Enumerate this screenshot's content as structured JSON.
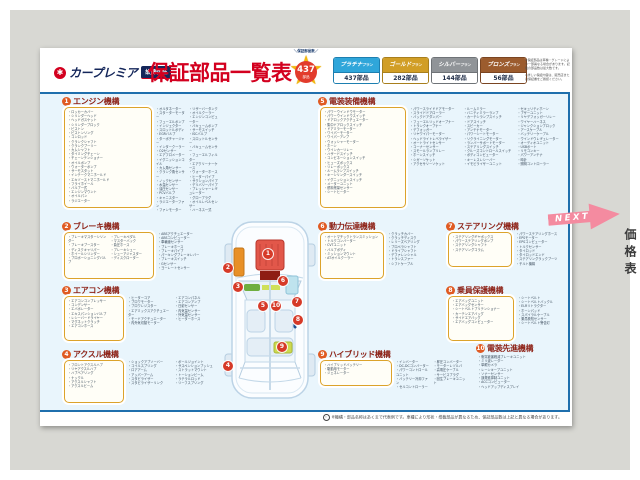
{
  "brand": {
    "name": "カープレミア",
    "badge": "故障保証"
  },
  "title": "保証部品一覧表",
  "count_badge": {
    "label": "＼保証部品数／",
    "count": "437",
    "unit": "部品"
  },
  "plans": [
    {
      "key": "platinum",
      "name": "プラチナ",
      "suffix": "プラン",
      "count": "437部品",
      "color": "#2fa6da",
      "dark": "#1d7fb0"
    },
    {
      "key": "gold",
      "name": "ゴールド",
      "suffix": "プラン",
      "count": "282部品",
      "color": "#d19e26",
      "dark": "#a87f1d"
    },
    {
      "key": "silver",
      "name": "シルバー",
      "suffix": "プラン",
      "count": "144部品",
      "color": "#909498",
      "dark": "#6f7377"
    },
    {
      "key": "bronze",
      "name": "ブロンズ",
      "suffix": "プラン",
      "count": "56部品",
      "color": "#9c5c2e",
      "dark": "#7a4522"
    }
  ],
  "header_notes": [
    "※保証部品は車種・グレードにより一部異なる場合があります。記載の部品数は最大数です。",
    "※詳しい保証内容は、販売店または保証書をご確認ください。"
  ],
  "sections": [
    {
      "key": "engine",
      "num": "1",
      "title": "エンジン機構",
      "box": [
        "ロッカーカバー",
        "シリンダーヘッド",
        "ヘッドガスケット",
        "シリンダーブロック",
        "ピストン",
        "ピストンリング",
        "コンロッド",
        "クランクシャフト",
        "クランクプーリー",
        "カムシャフト",
        "タイミングチェーン",
        "チェーンテンショナー",
        "オイルポンプ",
        "ウォーターポンプ",
        "サーモスタット",
        "インテークマニホールド",
        "エキゾーストマニホールド",
        "フライホイール",
        "バルブ一式",
        "エンジンマウント",
        "オイルパン",
        "ラジエーター"
      ],
      "out": [
        "オルタネーター",
        "スターターモーター",
        "フューエルポンプ",
        "インジェクター",
        "スロットルボディ",
        "EGRバルブ",
        "ターボチャージャー",
        "インタークーラー",
        "O2センサー",
        "エアフロメーター",
        "イグニッションコイル",
        "カム角センサー",
        "クランク角センサー",
        "ノックセンサー",
        "水温センサー",
        "油圧センサー",
        "PCVバルブ",
        "キャニスター",
        "ラジエーターファン",
        "ファンモーター",
        "リザーバータンク",
        "オイルクーラー",
        "エンジンコンピューター",
        "バキュームポンプ",
        "サーモスイッチ",
        "ISCバルブ",
        "スロットルセンサー",
        "バキュームセンサー",
        "フューエルフィルター",
        "エアクリーナーケース",
        "ウォーターホース",
        "ヒーターパイプ",
        "サクションパイプ",
        "デリバリーパイプ",
        "プレッシャーレギュレーター",
        "グロープラグ",
        "オイルレベルセンサー",
        "ハーネス一式"
      ]
    },
    {
      "key": "brake",
      "num": "2",
      "title": "ブレーキ機構",
      "box": [
        "ブレーキマスターシリンダー",
        "ブレーキブースター",
        "ディスクキャリパー",
        "ホイールシリンダー",
        "プロポーショニングバルブ",
        "ブレーキペダル",
        "マスターバック",
        "負圧ホース",
        "ブレーキシュー",
        "シューアジャスター",
        "ディスクローター"
      ],
      "out": [
        "ABSアクチュエーター",
        "ABSコンピューター",
        "車輪速センサー",
        "ブレーキホース",
        "ブレーキパイプ",
        "パーキングブレーキレバー",
        "ブレーキスイッチ",
        "Gセンサー",
        "ヨーレートセンサー"
      ]
    },
    {
      "key": "aircon",
      "num": "3",
      "title": "エアコン機構",
      "box": [
        "エアコンコンプレッサー",
        "コンデンサー",
        "エバポレーター",
        "エキスパンションバルブ",
        "レシーバードライヤー",
        "マグネットクラッチ",
        "エアコンホース"
      ],
      "out": [
        "ヒーターコア",
        "ブロワモーター",
        "ブロワレジスター",
        "エアミックスアクチュエーター",
        "モードアクチュエーター",
        "内外気切替モーター",
        "エアコンパネル",
        "エアコンアンプ",
        "日射センサー",
        "内気温センサー",
        "外気温センサー",
        "ヒーターホース"
      ]
    },
    {
      "key": "axle",
      "num": "4",
      "title": "アクスル機構",
      "box": [
        "フロントアクスルハブ",
        "リヤアクスルハブ",
        "ハブベアリング",
        "ナックル",
        "アクスルシャフト",
        "アクスルビーム"
      ],
      "out": [
        "ショックアブソーバー",
        "コイルスプリング",
        "ロアアーム",
        "アッパーアーム",
        "スタビライザー",
        "スタビライザーリンク",
        "ボールジョイント",
        "サスペンションブッシュ",
        "ストラットマウント",
        "トーションビーム",
        "ラテラルロッド",
        "リーフスプリング"
      ]
    },
    {
      "key": "electrical",
      "num": "5",
      "title": "電装装備機構",
      "box": [
        "パワーウインドウモーター",
        "パワーウインドウスイッチ",
        "ドアロックアクチュエーター",
        "集中ドアロックスイッチ",
        "ドアミラーモーター",
        "ワイパーモーター",
        "ワイパーアンプ",
        "ウォッシャーモーター",
        "ホーン",
        "ウインカーリレー",
        "ハザードスイッチ",
        "コンビネーションスイッチ",
        "ヒューズボックス",
        "リレーボックス",
        "ルームランプスイッチ",
        "キーシリンダースイッチ",
        "イグニッションスイッチ",
        "メーターユニット",
        "燃料残量センサー",
        "シートヒーター"
      ],
      "out": [
        "パワースライドドアモーター",
        "スライドドアローラー",
        "バックドアダンパー",
        "フューエルリッドオープナー",
        "トランクオープナー",
        "デフォッガー",
        "リヤワイパーモーター",
        "ヘッドライトレベライザー",
        "オートライトセンサー",
        "コーナーセンサー",
        "スモールランプリレー",
        "ホーンスイッチ",
        "シガーソケット",
        "アクセサリーソケット",
        "ルームミラー",
        "バニティミラーランプ",
        "カーテシランプスイッチ",
        "ドアスイッチ",
        "スピーカー",
        "アンテナモーター",
        "パワーシートモーター",
        "リクライニングモーター",
        "ランバーサポートモーター",
        "ステアリングスイッチ",
        "クルーズコントロールスイッチ",
        "ボディコンピューター",
        "キーレスレシーバー",
        "イモビライザーユニット",
        "セキュリティホーン",
        "ブザーユニット",
        "リヤデフォッガーリレー",
        "ワイヤーハーネス",
        "ジャンクションブロック",
        "アースケーブル",
        "バッテリーケーブル",
        "ウインドウレギュレーター",
        "オーディオユニット",
        "USBポート",
        "リモコンキー",
        "パワーアンテナ",
        "時計",
        "照明コントローラー"
      ]
    },
    {
      "key": "drivetrain",
      "num": "6",
      "title": "動力伝達機構",
      "box": [
        "オートマチックトランスミッション",
        "トルクコンバーター",
        "CVTユニット",
        "バルブボディ",
        "ミッションマウント",
        "ATオイルクーラー"
      ],
      "out": [
        "クラッチカバー",
        "クラッチディスク",
        "レリーズベアリング",
        "プロペラシャフト",
        "ドライブシャフト",
        "デファレンシャル",
        "トランスファー",
        "シフトケーブル"
      ]
    },
    {
      "key": "steering",
      "num": "7",
      "title": "ステアリング機構",
      "box": [
        "ステアリングギヤボックス",
        "パワーステアリングポンプ",
        "ステアリングシャフト",
        "ステアリングコラム"
      ],
      "out": [
        "パワーステアリングホース",
        "EPSモーター",
        "EPSコンピューター",
        "トルクセンサー",
        "タイロッド",
        "タイロッドエンド",
        "ステアリングラックブーツ",
        "チルト機構"
      ]
    },
    {
      "key": "safety",
      "num": "8",
      "title": "乗員保護機構",
      "box": [
        "エアバッグユニット",
        "エアバッグセンサー",
        "シートベルトプリテンショナー",
        "カーテンエアバッグ",
        "サイドエアバッグ",
        "エアバッグコンピューター"
      ],
      "out": [
        "シートベルト",
        "シートベルトバックル",
        "ELRリトラクター",
        "ホーンパッド",
        "スパイラルケーブル",
        "乗員検知センサー",
        "シートベルト警告灯"
      ]
    },
    {
      "key": "hybrid",
      "num": "9",
      "title": "ハイブリッド機構",
      "box": [
        "ハイブリッドバッテリー",
        "駆動用モーター",
        "ジェネレーター"
      ],
      "out": [
        "インバーター",
        "DC-DCコンバーター",
        "パワーコントロールユニット",
        "バッテリー冷却ファン",
        "セルコントローラー",
        "昇圧コンバーター",
        "モーターレゾルバ",
        "高電圧ケーブル",
        "サービスプラグ",
        "回生ブレーキユニット"
      ]
    },
    {
      "key": "adas",
      "num": "10",
      "title": "電装先進機構",
      "box": [],
      "out": [
        "衝突被害軽減ブレーキユニット",
        "ミリ波レーダー",
        "単眼カメラ",
        "レーンキープユニット",
        "ソナーセンサー",
        "誤発進抑制ユニット",
        "ACCコンピューター",
        "ヘッドアップディスプレイ"
      ]
    }
  ],
  "next_label": "NEXT",
  "side_tab_label": "価格表",
  "footer_note": "※機構・部品名称はあくまで代表例です。車種により形状・搭載部品が異なるため、保証部品数は上記と異なる場合があります。"
}
